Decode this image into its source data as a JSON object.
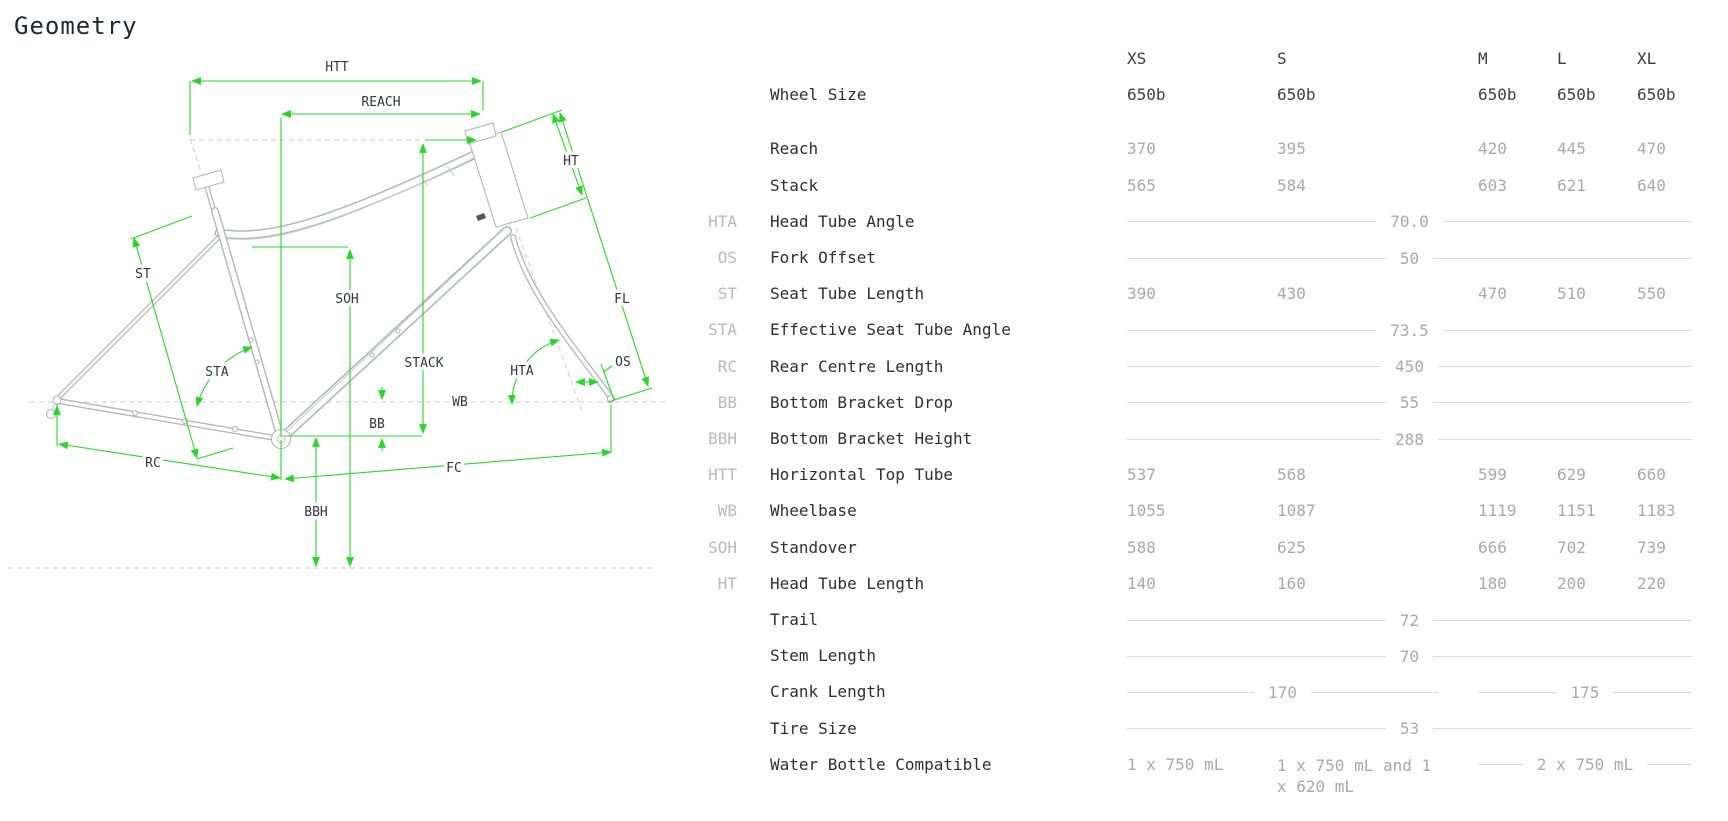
{
  "page": {
    "title": "Geometry"
  },
  "colors": {
    "dimension_green": "#2bd52b",
    "frame_gray": "#b3b6b8",
    "rule_gray": "#dcdcdc",
    "label_dark": "#2f2f2f",
    "value_gray": "#a9a9a9",
    "abbr_gray": "#b9b9b9"
  },
  "diagram": {
    "labels": {
      "htt": "HTT",
      "reach": "REACH",
      "ht": "HT",
      "fl": "FL",
      "os": "OS",
      "hta": "HTA",
      "wb": "WB",
      "stack": "STACK",
      "soh": "SOH",
      "bb": "BB",
      "bbh": "BBH",
      "rc": "RC",
      "fc": "FC",
      "st": "ST",
      "sta": "STA"
    }
  },
  "table": {
    "sizes": [
      "XS",
      "S",
      "M",
      "L",
      "XL"
    ],
    "rows": [
      {
        "type": "wheel",
        "abbr": "",
        "label": "Wheel Size",
        "values": [
          "650b",
          "650b",
          "650b",
          "650b",
          "650b"
        ]
      },
      {
        "type": "spacer"
      },
      {
        "type": "values",
        "abbr": "",
        "label": "Reach",
        "values": [
          "370",
          "395",
          "420",
          "445",
          "470"
        ]
      },
      {
        "type": "values",
        "abbr": "",
        "label": "Stack",
        "values": [
          "565",
          "584",
          "603",
          "621",
          "640"
        ]
      },
      {
        "type": "merged",
        "abbr": "HTA",
        "label": "Head Tube Angle",
        "value": "70.0"
      },
      {
        "type": "merged",
        "abbr": "OS",
        "label": "Fork Offset",
        "value": "50"
      },
      {
        "type": "values",
        "abbr": "ST",
        "label": "Seat Tube Length",
        "values": [
          "390",
          "430",
          "470",
          "510",
          "550"
        ]
      },
      {
        "type": "merged",
        "abbr": "STA",
        "label": "Effective Seat Tube Angle",
        "value": "73.5"
      },
      {
        "type": "merged",
        "abbr": "RC",
        "label": "Rear Centre Length",
        "value": "450"
      },
      {
        "type": "merged",
        "abbr": "BB",
        "label": "Bottom Bracket Drop",
        "value": "55"
      },
      {
        "type": "merged",
        "abbr": "BBH",
        "label": "Bottom Bracket Height",
        "value": "288"
      },
      {
        "type": "values",
        "abbr": "HTT",
        "label": "Horizontal Top Tube",
        "values": [
          "537",
          "568",
          "599",
          "629",
          "660"
        ]
      },
      {
        "type": "values",
        "abbr": "WB",
        "label": "Wheelbase",
        "values": [
          "1055",
          "1087",
          "1119",
          "1151",
          "1183"
        ]
      },
      {
        "type": "values",
        "abbr": "SOH",
        "label": "Standover",
        "values": [
          "588",
          "625",
          "666",
          "702",
          "739"
        ]
      },
      {
        "type": "values",
        "abbr": "HT",
        "label": "Head Tube Length",
        "values": [
          "140",
          "160",
          "180",
          "200",
          "220"
        ]
      },
      {
        "type": "merged",
        "abbr": "",
        "label": "Trail",
        "value": "72"
      },
      {
        "type": "merged",
        "abbr": "",
        "label": "Stem Length",
        "value": "70"
      },
      {
        "type": "split",
        "abbr": "",
        "label": "Crank Length",
        "left": "170",
        "right": "175"
      },
      {
        "type": "merged",
        "abbr": "",
        "label": "Tire Size",
        "value": "53"
      },
      {
        "type": "bottle",
        "abbr": "",
        "label": "Water Bottle Compatible",
        "xs": "1 x 750 mL",
        "s": "1 x 750 mL and 1 x 620 mL",
        "mlxl": "2 x 750 mL"
      }
    ]
  }
}
